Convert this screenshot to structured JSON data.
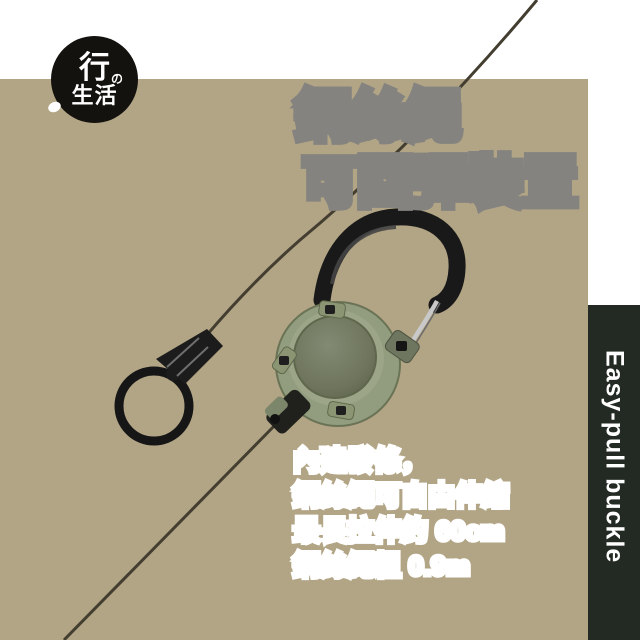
{
  "brand": {
    "char_top": "行",
    "mark": "の",
    "chars_bottom": "生活"
  },
  "title": {
    "line1": "鋼絲繩",
    "line2": "可回彈裝置"
  },
  "specs": {
    "lines": [
      "內建發條，",
      "鋼絲繩可自由伸縮",
      "最長拉伸約 60cm",
      "鋼絲繩粗 0.9m"
    ]
  },
  "side_banner": {
    "text": "Easy-pull buckle"
  },
  "colors": {
    "backdrop_tan": "#b2a585",
    "banner_dark": "#232a24",
    "title_fill": "#ffffff",
    "title_outline": "#84837f",
    "spec_text": "#333333",
    "spec_outline": "#ffffff",
    "carabiner_body_green": "#929c7e",
    "carabiner_disc_green": "#6e755c",
    "hook_black": "#191919",
    "gate_silver": "#c9c9c9",
    "wire_dark": "#443e31",
    "logo_bg": "#14120f"
  }
}
